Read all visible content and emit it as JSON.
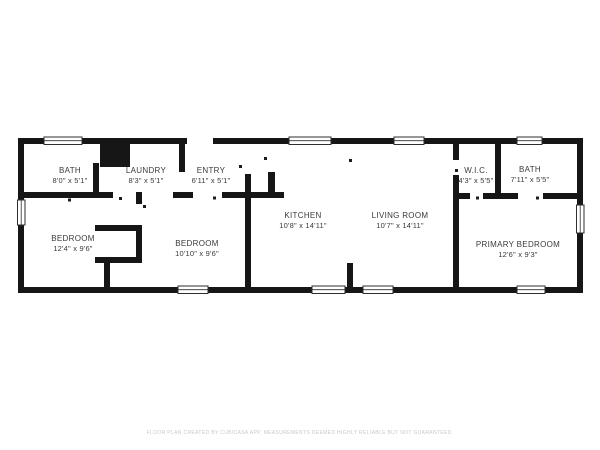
{
  "rooms": {
    "bath": {
      "label": "BATH",
      "dims": "8'0\" x 5'1\""
    },
    "laundry": {
      "label": "LAUNDRY",
      "dims": "8'3\" x 5'1\""
    },
    "entry": {
      "label": "ENTRY",
      "dims": "6'11\" x 5'1\""
    },
    "bedroom1": {
      "label": "BEDROOM",
      "dims": "12'4\" x 9'6\""
    },
    "bedroom2": {
      "label": "BEDROOM",
      "dims": "10'10\" x 9'6\""
    },
    "kitchen": {
      "label": "KITCHEN",
      "dims": "10'8\" x 14'11\""
    },
    "living_room": {
      "label": "LIVING ROOM",
      "dims": "10'7\" x 14'11\""
    },
    "wic": {
      "label": "W.I.C.",
      "dims": "4'3\" x 5'5\""
    },
    "bath2": {
      "label": "BATH",
      "dims": "7'11\" x 5'5\""
    },
    "primary_bedroom": {
      "label": "PRIMARY BEDROOM",
      "dims": "12'6\" x 9'3\""
    }
  },
  "footer": {
    "text": "FLOOR PLAN CREATED BY CUBICASA APP. MEASUREMENTS DEEMED HIGHLY RELIABLE BUT NOT GUARANTEED."
  },
  "colors": {
    "wall": "#161616",
    "label_text": "#3a3a3a",
    "footer_text": "#c9c9c9"
  }
}
